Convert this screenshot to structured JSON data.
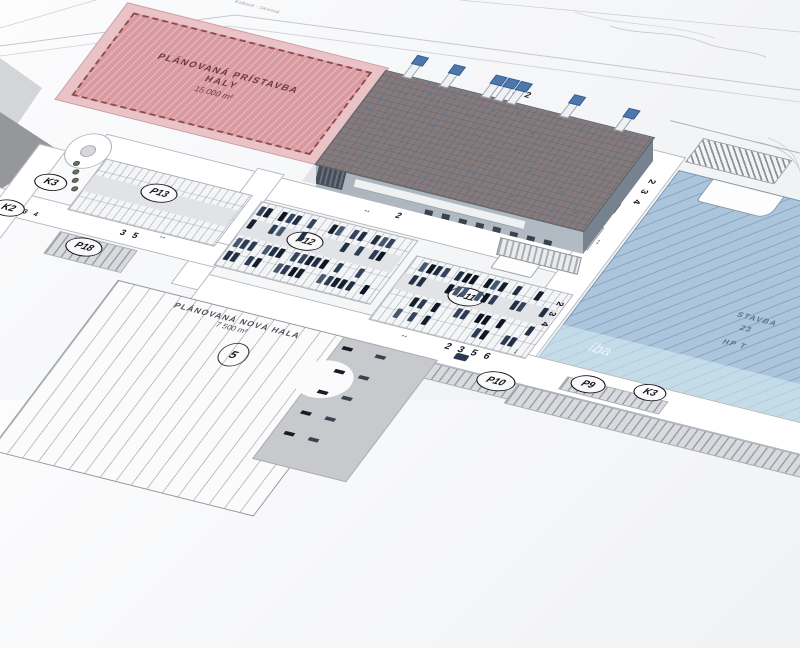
{
  "map": {
    "road_name_top": "Kolková - Okresná",
    "planned_extension": {
      "line1": "PLÁNOVANÁ PRÍSTAVBA",
      "line2": "HALY",
      "area": "15 000 m²"
    },
    "planned_hall": {
      "line1": "PLÁNOVANÁ NOVÁ HALA",
      "area": "7 500 m²",
      "marker": "5"
    },
    "parking_labels": {
      "p13": "P13",
      "p12": "P12",
      "p11": "P11",
      "p10": "P10",
      "p9": "P9",
      "p18": "P18"
    },
    "junction_labels": {
      "k3_left": "K3",
      "k2_left": "K2",
      "k3_bottom": "K3"
    },
    "road_labels": {
      "north": "3 2",
      "mid": "2",
      "east_vertical": "2 3 4",
      "south": "2 3 5 6",
      "west": "3 5",
      "west_small": "3 4"
    },
    "existing_hall": {
      "line1": "STAVBA",
      "line2": "23",
      "line3": "HP T",
      "watermark": "iba"
    },
    "icons": {
      "dim_arrow": "↔"
    }
  },
  "colors": {
    "planned_extension_fill": "#d99aa0",
    "planned_extension_border": "#8d4a52",
    "existing_hall_fill": "#aac5dc",
    "building_roof": "#847b7f",
    "building_wall_front": "#aeb7c0",
    "building_wall_side": "#76828e",
    "parking_asphalt": "#e2e3e6",
    "car_dark": "#1b2736",
    "car_blue": "#3e69b3"
  }
}
